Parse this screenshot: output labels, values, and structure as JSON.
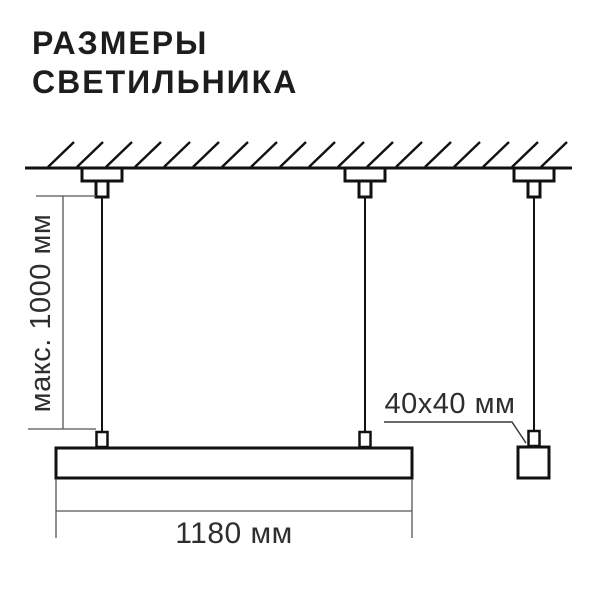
{
  "title": {
    "line1": "РАЗМЕРЫ",
    "line2": "СВЕТИЛЬНИКА"
  },
  "diagram": {
    "dimension_max_height": "макс. 1000 мм",
    "dimension_length": "1180 мм",
    "dimension_profile": "40x40 мм"
  },
  "colors": {
    "background": "#ffffff",
    "drawing_line": "#111111",
    "dimension_line": "#555555",
    "dimension_text": "#2e2e2e",
    "title_text": "#1d1d1d"
  }
}
